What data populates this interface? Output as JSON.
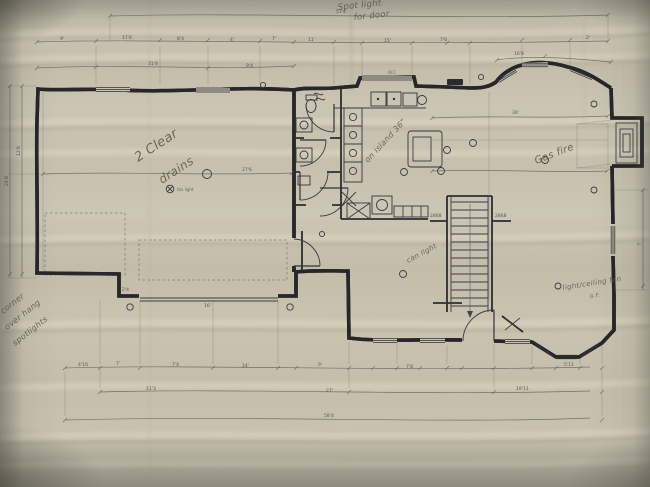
{
  "scene": {
    "description": "Photograph of a hand-drafted first-floor house plan on creased beige drafting paper",
    "paper_color": "#c7c1ae",
    "ink_color": "#2a2a30",
    "pencil_color": "#5e5a4e"
  },
  "annotations": {
    "top_note_l1": "Spot light",
    "top_note_l2": "for door",
    "garage_note_l1": "2 Clear",
    "garage_note_l2": "drains",
    "island_note": "on island 36\"",
    "fireplace_note": "Gas fire",
    "fan_note": "light/ceiling fan",
    "fan_note_sub": "G.F.",
    "margin_note_l1": "corner",
    "margin_note_l2": "over hang",
    "margin_note_l3": "spotlights",
    "room_note": "can light",
    "garage_fan_note": "fan light",
    "acc_label": "ACC"
  },
  "dimensions": {
    "top_row1": [
      "57'4"
    ],
    "top_row2": [
      "9'",
      "17'6",
      "8'4",
      "4'",
      "7'",
      "11'",
      "15'",
      "7'6",
      "2'"
    ],
    "top_row3": [
      "31'8",
      "16'8",
      "9'4"
    ],
    "left_col": [
      "24'8",
      "12'6"
    ],
    "right_col": [
      "7'"
    ],
    "bottom_row1": [
      "4'10",
      "7'",
      "7'4",
      "14'",
      "9'",
      "7'8",
      "5'11"
    ],
    "bottom_row2": [
      "11'3",
      "27'",
      "19'11"
    ],
    "bottom_row3": [
      "58'4"
    ],
    "interior": [
      "27'6",
      "30'",
      "16'",
      "2868",
      "2868",
      "2'4"
    ]
  }
}
